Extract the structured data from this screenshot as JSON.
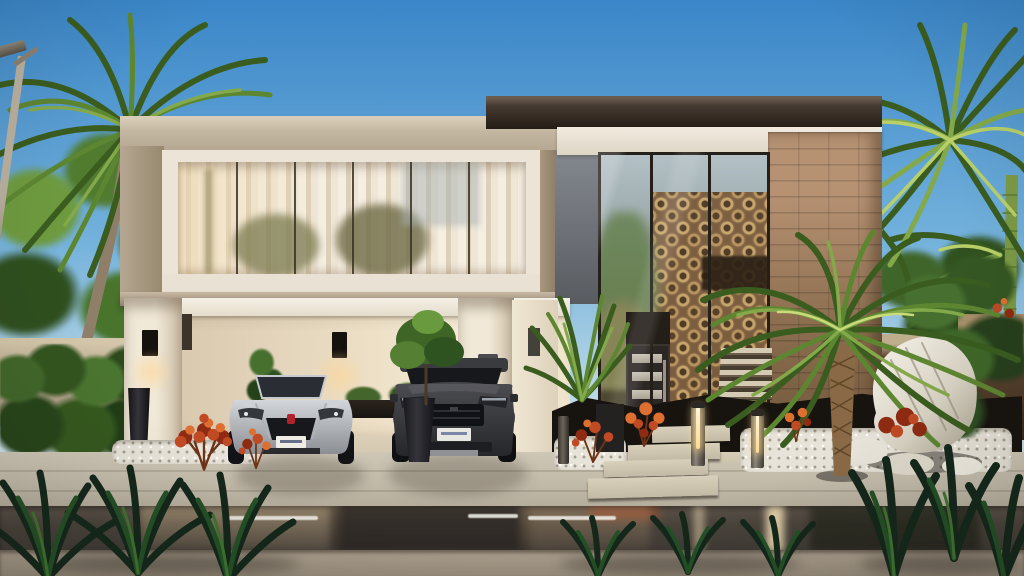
{
  "scene": {
    "type": "architectural-exterior-rendering",
    "description": "Photorealistic render of a modern two-story luxury villa at street level: white cantilevered volume with curtained ribbon window over a double carport (silver convertible and dark SUV), dark-roofed glass entry volume with bronze circle-pattern screen and brick pier, tropical landscaping with palms, red accent plants, white pebbles and boulders, bollard lights, and a wet asphalt road in the foreground.",
    "time_of_day": "late-afternoon",
    "objects": [
      "sky",
      "palm-trees-left",
      "palm-trees-right",
      "street-lamp",
      "perimeter-wall-left",
      "perimeter-wall-right",
      "upper-volume-ribbon-window",
      "white-curtains",
      "carport",
      "wall-sconces",
      "carport-hedge-planter",
      "silver-convertible",
      "dark-suv",
      "tall-planter-pot",
      "dark-flat-roof",
      "brick-pier",
      "glass-curtain-wall",
      "bronze-pattern-screen",
      "entry-door",
      "entry-steps",
      "bollard-lights",
      "white-pebble-beds",
      "boulders",
      "phoenix-palm",
      "red-accent-plants",
      "hedge",
      "driveway",
      "stepping-stone-path",
      "wet-road",
      "lane-dashes",
      "sidewalk",
      "foreground-foliage"
    ],
    "vehicles": [
      {
        "name": "convertible",
        "body_color": "silver",
        "seat_color": "orange",
        "plate": "illegible-white"
      },
      {
        "name": "suv",
        "body_color": "dark-charcoal",
        "plate": "illegible-white"
      }
    ],
    "window_panes_left_volume": 6,
    "glass-bays-right-volume": 3,
    "bollard_count": 3,
    "lane_dash_count": 3
  },
  "palette": {
    "sky-top": "#3a86c8",
    "sky-mid": "#74b2dc",
    "sky-low": "#c4dde8",
    "sky-horizon": "#e7eeee",
    "concrete": "#b3a58f",
    "concrete-light": "#c4b7a1",
    "concrete-dark": "#97886f",
    "frame-white": "#ece5d7",
    "curtain": "#f5eee1",
    "curtain-shade": "#ddd0ba",
    "mullion": "#3a3127",
    "roof-dark": "#241c16",
    "fascia": "#f1ebdf",
    "brick": "#8d6f50",
    "brick-light": "#b69273",
    "brick-dark": "#6b5138",
    "glass-sky": "#b4c1c6",
    "glass-mid": "#8c958b",
    "glass-deep": "#6e7265",
    "bronze": "#7a5a3c",
    "bronze-ring": "#c9a66a",
    "door": "#2c2724",
    "door-pane": "#d5cfc0",
    "interior-dark": "#2b2015",
    "gap-wall": "#83888f",
    "wall-cap": "#bfae8e",
    "wall-brown": "#4e3a28",
    "palm-light": "#b9d069",
    "palm-mid": "#83a94a",
    "palm-deep": "#3a5c1f",
    "phoenix-trunk": "#8a6a46",
    "red-plant": "#c04a24",
    "red-orange": "#dd7031",
    "red-dark": "#8e2b12",
    "pebble": "#e7e3d8",
    "mulch": "#17130e",
    "road-dark": "#3f3a35",
    "sidewalk": "#ab9f8e",
    "glow": "#ffd98f",
    "foliage-deep": "#14271a",
    "foliage-mid": "#235026",
    "foliage-light": "#3f7330",
    "lamp-pole": "#23201d",
    "lamp-pole-top": "#b9b0a0"
  }
}
